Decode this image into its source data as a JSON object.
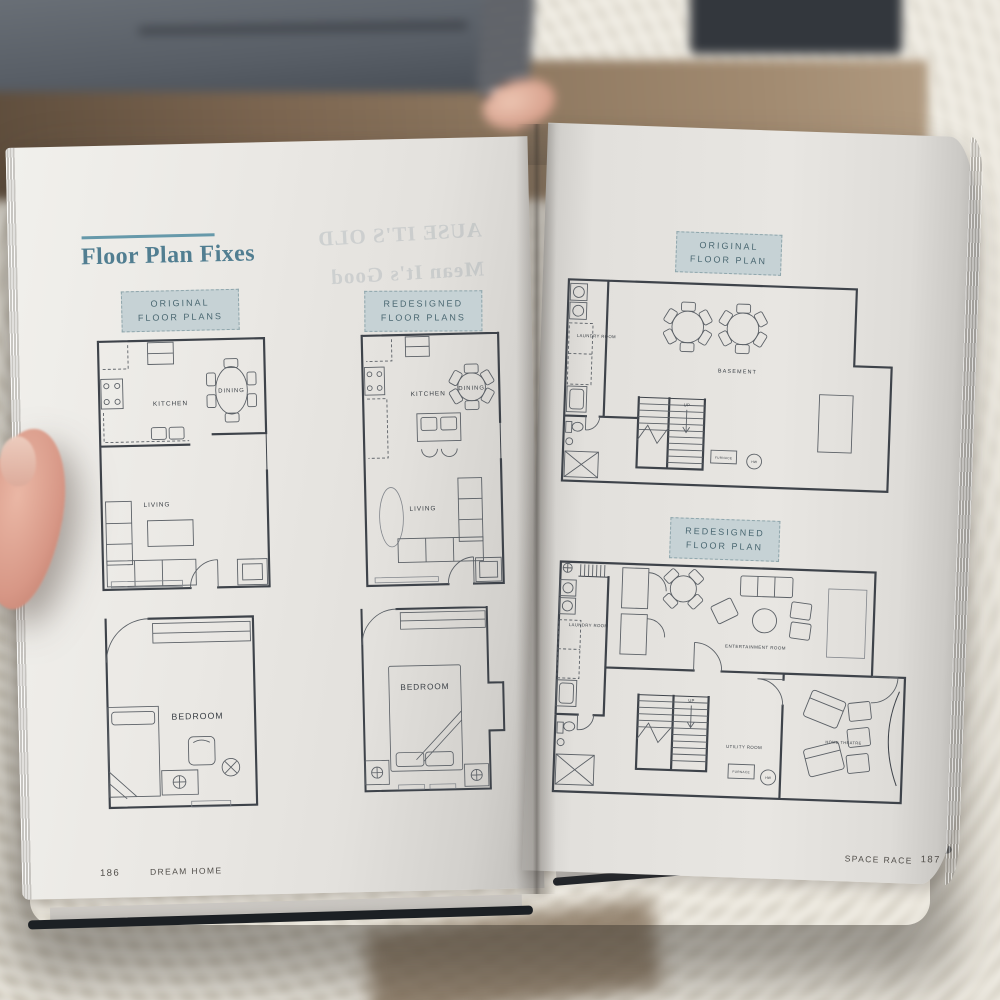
{
  "book": {
    "left_page": {
      "heading": "Floor Plan Fixes",
      "original_label": {
        "line1": "ORIGINAL",
        "line2": "FLOOR PLANS"
      },
      "redesigned_label": {
        "line1": "REDESIGNED",
        "line2": "FLOOR PLANS"
      },
      "bleedthrough": {
        "line1": "AUSE IT'S OLD",
        "line2": "Mean It's Good"
      },
      "footer": {
        "page_number": "186",
        "section": "DREAM HOME"
      }
    },
    "right_page": {
      "original_label": {
        "line1": "ORIGINAL",
        "line2": "FLOOR PLAN"
      },
      "redesigned_label": {
        "line1": "REDESIGNED",
        "line2": "FLOOR PLAN"
      },
      "footer": {
        "section": "SPACE RACE",
        "page_number": "187"
      }
    },
    "rooms": {
      "kitchen": "KITCHEN",
      "dining": "DINING",
      "living": "LIVING",
      "bedroom": "BEDROOM",
      "laundry": "LAUNDRY ROOM",
      "basement": "BASEMENT",
      "entertainment": "ENTERTAINMENT ROOM",
      "utility": "UTILITY ROOM",
      "home_theatre": "HOME THEATRE",
      "furnace": "FURNACE",
      "stairs_up": "UP",
      "water_heater": "HW"
    },
    "colors": {
      "accent_teal": "#517e91",
      "label_bg": "#c6d2d5",
      "label_text": "#4b6872",
      "plan_line": "#3e434a"
    }
  }
}
